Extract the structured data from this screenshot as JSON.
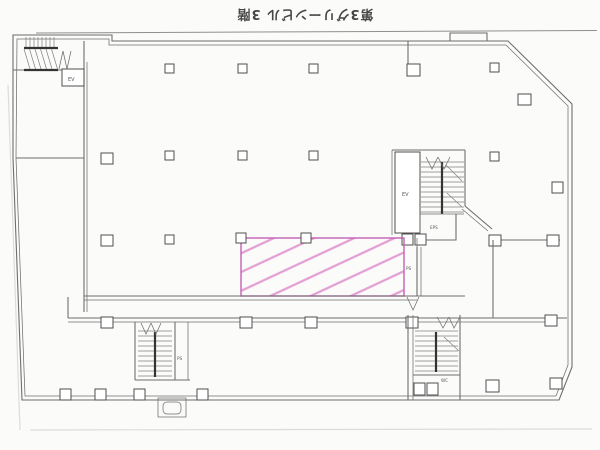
{
  "title": "第3グリーンビル 3階",
  "labels": {
    "elevator_upper_left": "EV",
    "elevator_core": "EV",
    "core_room": "EPS",
    "pipe_shaft_center": "PS",
    "pipe_shaft_lower_left": "PS",
    "restroom_lower_right": "WC"
  },
  "colors": {
    "paper": "#fbfbf9",
    "wall": "#6e6e6e",
    "wallDark": "#343434",
    "pink": "#c45fb5",
    "pinkHatch": "#e39fd4",
    "label": "#5a5a5a"
  }
}
